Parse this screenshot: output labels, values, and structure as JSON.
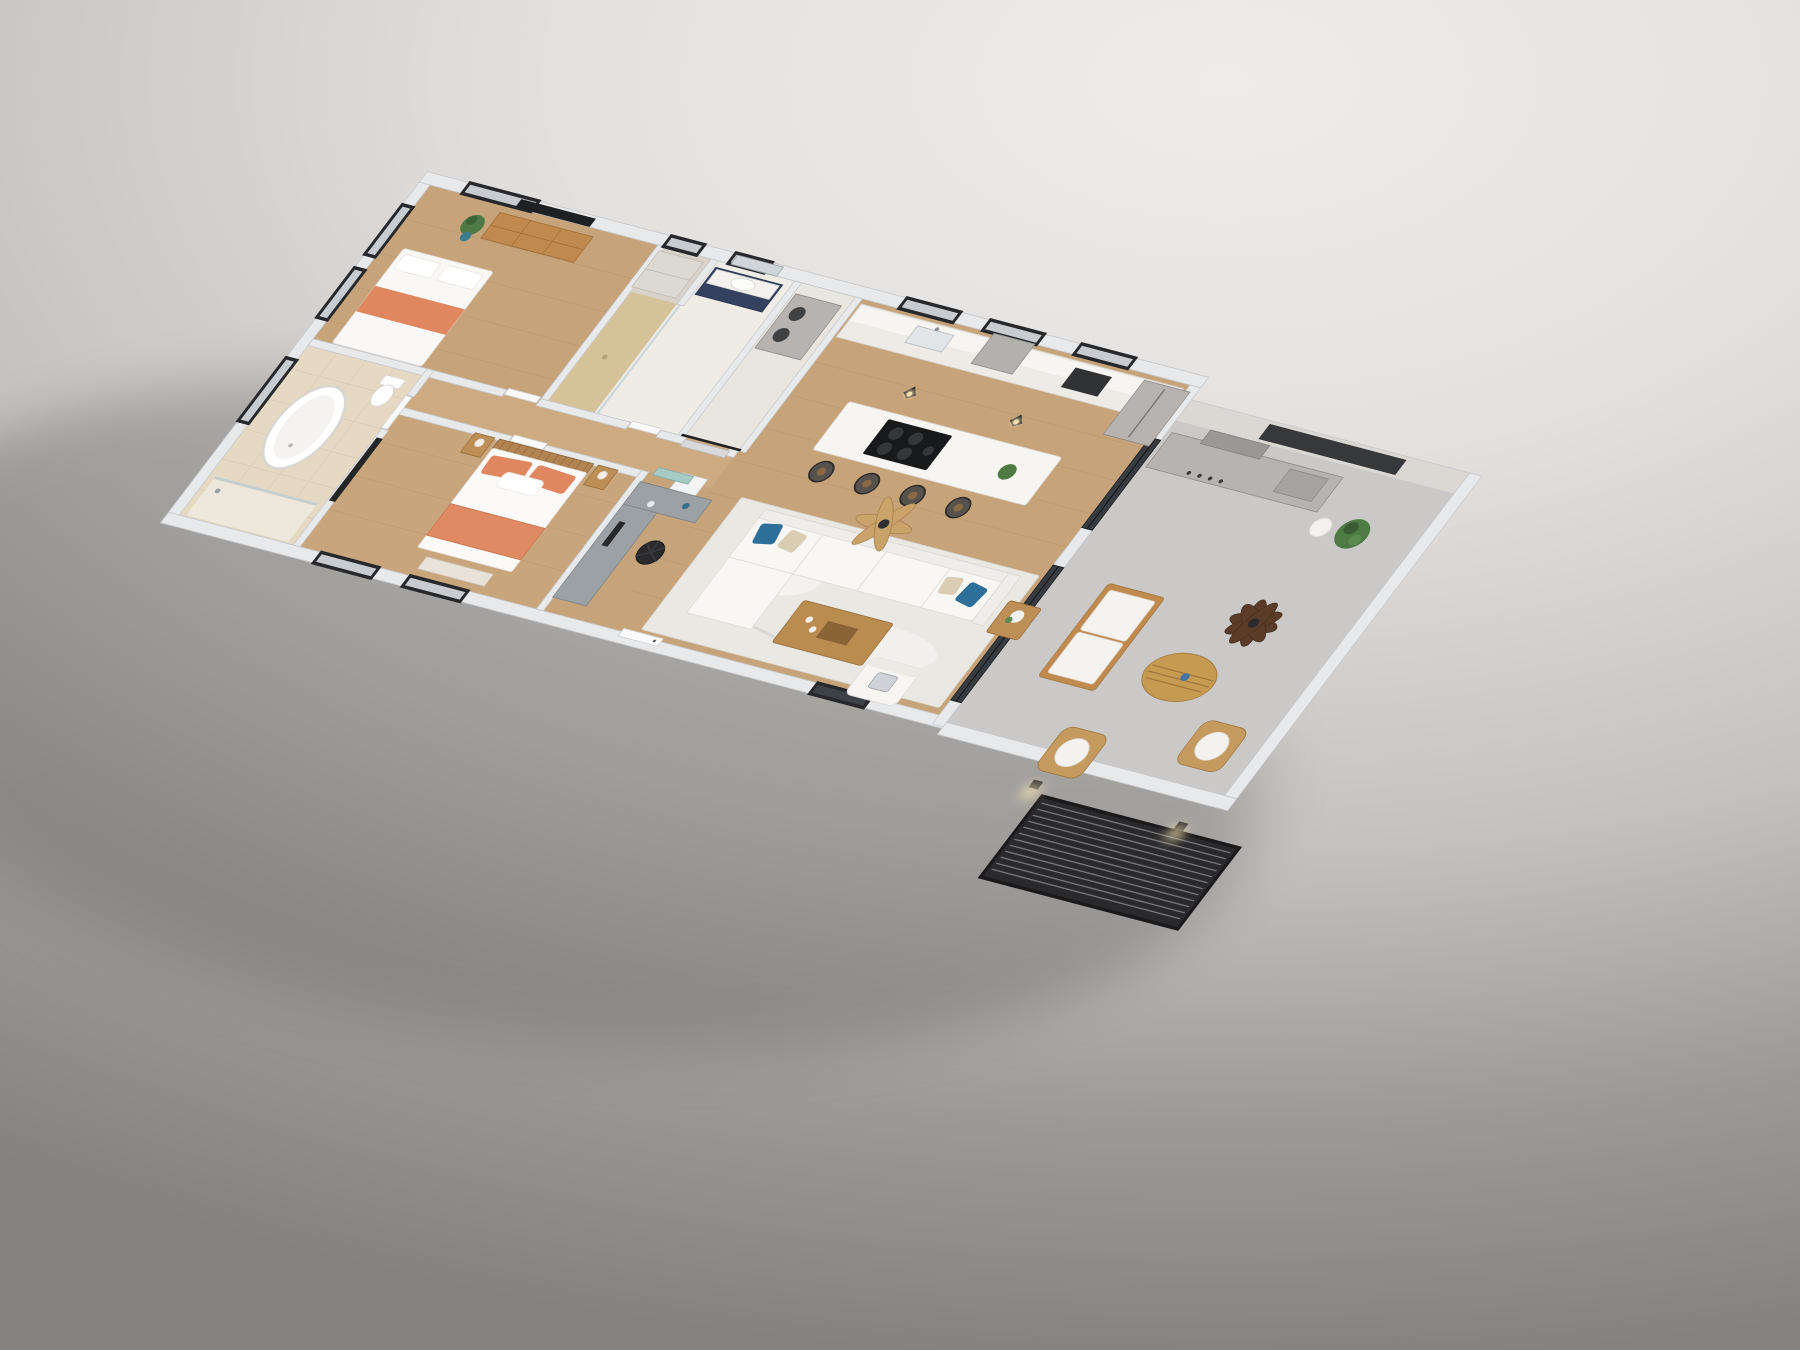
{
  "scene": {
    "kind": "3d-isometric-floor-plan-render",
    "subject": "two-bedroom apartment with open kitchen-living area and covered patio",
    "background": {
      "top": "#efedeb",
      "bottom": "#858381"
    },
    "rooms": [
      {
        "id": "bedroom-2",
        "floor": "wood",
        "furniture": [
          "bed-white-coral-runner",
          "wood-dresser",
          "wall-tv",
          "potted-plant",
          "closet-cabinet"
        ]
      },
      {
        "id": "bathroom-2",
        "floor": "white-tile",
        "furniture": [
          "navy-vanity-white-top",
          "wall-mirror",
          "walk-in-shower-tan-tile"
        ]
      },
      {
        "id": "laundry-closet",
        "floor": "white-tile",
        "furniture": [
          "stacked-washer-dryer",
          "black-barn-door-rail",
          "wall-water-heater"
        ]
      },
      {
        "id": "kitchen",
        "floor": "wood",
        "furniture": [
          "white-counter-run",
          "range-hood",
          "wall-oven",
          "sink",
          "stainless-fridge",
          "marble-island-black-cooktop",
          "four-bar-stools",
          "two-pendant-lights"
        ]
      },
      {
        "id": "living-room",
        "floor": "wood",
        "furniture": [
          "white-sectional-sofa",
          "blue-pillows",
          "beige-pillows",
          "distressed-white-rug",
          "wood-coffee-table",
          "side-table-flowers",
          "white-armchair",
          "wood-ceiling-fan",
          "dark-sliding-glass-doors"
        ]
      },
      {
        "id": "office-nook",
        "floor": "wood",
        "furniture": [
          "gray-desk",
          "monitor",
          "black-office-chair",
          "teal-wall-art"
        ]
      },
      {
        "id": "master-bedroom",
        "floor": "wood",
        "furniture": [
          "bed-slat-headboard",
          "coral-pillows",
          "coral-throw",
          "two-nightstands-lamps",
          "foot-bench",
          "wall-tv-partition"
        ]
      },
      {
        "id": "master-bathroom",
        "floor": "beige-tile",
        "furniture": [
          "freestanding-oval-tub",
          "toilet",
          "glass-shower"
        ]
      },
      {
        "id": "patio",
        "floor": "concrete",
        "furniture": [
          "outdoor-grill-counter",
          "dark-palm-ceiling-fan",
          "wood-frame-loveseat",
          "oval-wood-table",
          "two-rattan-armchairs",
          "potted-plants",
          "black-louvered-pergola",
          "wall-sconces"
        ]
      }
    ],
    "palette": {
      "wall": "#e8e9eb",
      "wallEdge": "#c6c9cd",
      "patioWall": "#dbd8d4",
      "woodFloor": "#c7a379",
      "plank": "#a9875f",
      "tileBeige": "#e5d9c3",
      "tileWhite": "#efece6",
      "tileTan": "#d6c298",
      "closetWood": "#d8d2c8",
      "concrete": "#cac9c7",
      "windowFrame": "#26282b",
      "glass": "#c7ccd0",
      "glassDark": "#383c40",
      "accentCoral": "#e0875f",
      "accentBlue": "#2e6f99",
      "woodFurniture": "#c08a4f",
      "navy": "#35425f",
      "stainless": "#b6b3b0",
      "sofaWhite": "#f8f7f4",
      "rug": "#eae8e3",
      "pergola": "#2a2a2c",
      "pergolaSlat": "#74747a",
      "fanWood": "#c9a36a",
      "fanDark": "#5b3c29",
      "plantGreen": "#4e7a43",
      "deskGray": "#9ba1a5",
      "tealArt": "#a6cac4",
      "shadow": "#55534f"
    }
  }
}
